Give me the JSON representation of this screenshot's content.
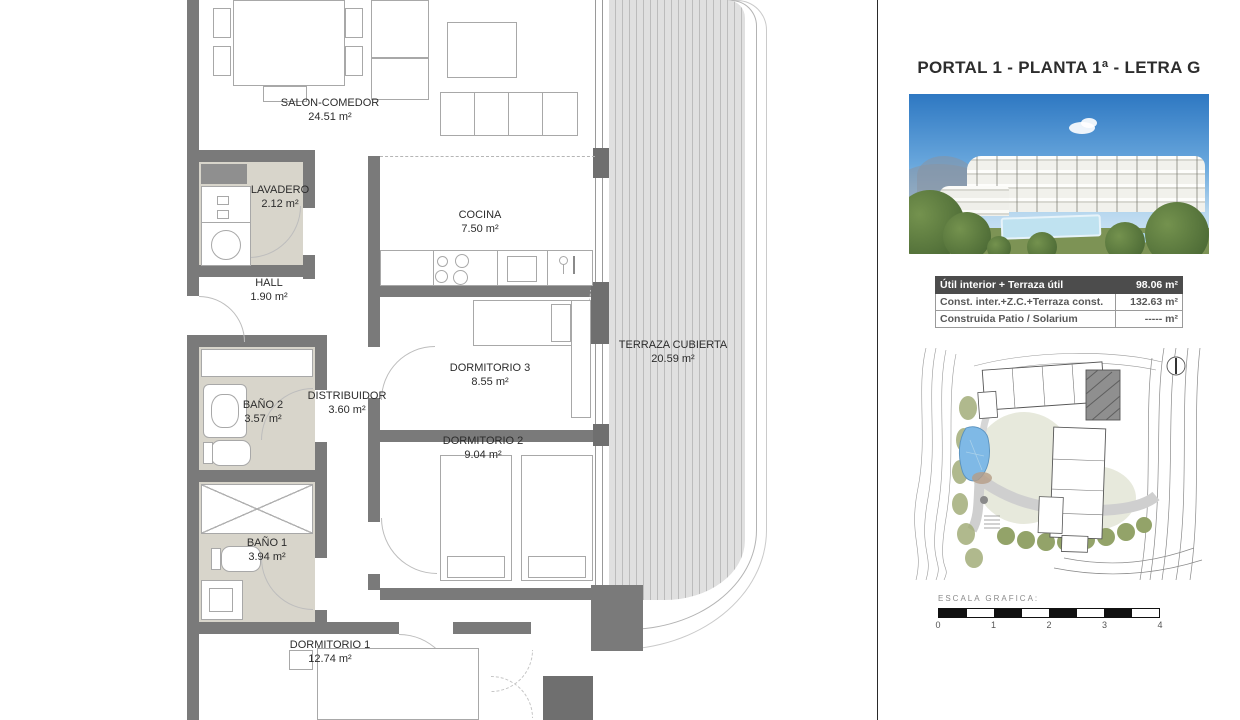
{
  "panel": {
    "title": "PORTAL 1 - PLANTA 1ª - LETRA G",
    "table": {
      "rows": [
        {
          "label": "Útil interior + Terraza útil",
          "value": "98.06 m²"
        },
        {
          "label": "Const. inter.+Z.C.+Terraza const.",
          "value": "132.63 m²"
        },
        {
          "label": "Construida Patio / Solarium",
          "value": "----- m²"
        }
      ]
    },
    "scale": {
      "label": "ESCALA GRAFICA:",
      "ticks": [
        "0",
        "1",
        "2",
        "3",
        "4"
      ]
    }
  },
  "plan": {
    "rooms": [
      {
        "name": "SALON-COMEDOR",
        "area": "24.51 m²"
      },
      {
        "name": "LAVADERO",
        "area": "2.12 m²"
      },
      {
        "name": "COCINA",
        "area": "7.50 m²"
      },
      {
        "name": "HALL",
        "area": "1.90 m²"
      },
      {
        "name": "BAÑO 2",
        "area": "3.57 m²"
      },
      {
        "name": "DISTRIBUIDOR",
        "area": "3.60 m²"
      },
      {
        "name": "DORMITORIO 3",
        "area": "8.55 m²"
      },
      {
        "name": "DORMITORIO 2",
        "area": "9.04 m²"
      },
      {
        "name": "BAÑO 1",
        "area": "3.94 m²"
      },
      {
        "name": "DORMITORIO 1",
        "area": "12.74 m²"
      },
      {
        "name": "TERRAZA CUBIERTA",
        "area": "20.59 m²"
      }
    ]
  },
  "colors": {
    "wall_gray": "#7a7a7a",
    "bath_floor": "#d8d5cb",
    "table_header": "#4c4c4c",
    "pool_blue": "#7fb9e6",
    "sky_blue": "#2e78c2"
  }
}
